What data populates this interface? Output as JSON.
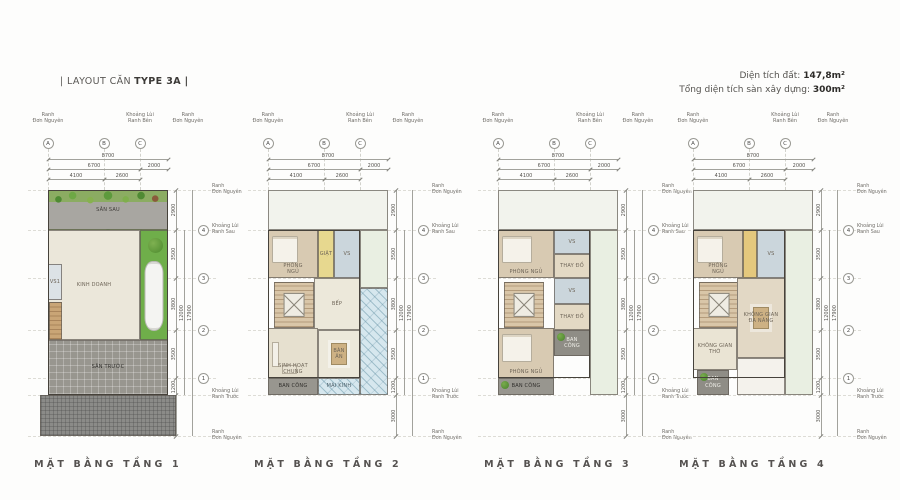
{
  "header": {
    "layout_prefix": "| LAYOUT CĂN",
    "layout_type": "TYPE 3A |",
    "land_area_label": "Diện tích đất:",
    "land_area_value": "147,8m²",
    "floor_area_label": "Tổng diện tích sàn xây dựng:",
    "floor_area_value": "300m²"
  },
  "annotations": {
    "top_labels": [
      {
        "text": "Ranh\nĐơn Nguyên",
        "cx": 30
      },
      {
        "text": "Khoảng Lùi\nRanh Bên",
        "cx": 122
      },
      {
        "text": "Ranh\nĐơn Nguyên",
        "cx": 170
      }
    ],
    "col_markers": [
      {
        "label": "A",
        "x": 0
      },
      {
        "label": "B",
        "x": 56
      },
      {
        "label": "C",
        "x": 92
      }
    ],
    "h_dim_rows": [
      {
        "y": 47,
        "spans": [
          {
            "label": "8700",
            "from": 0,
            "to": 120
          }
        ]
      },
      {
        "y": 57,
        "spans": [
          {
            "label": "6700",
            "from": 0,
            "to": 92
          },
          {
            "label": "2000",
            "from": 92,
            "to": 120
          }
        ]
      },
      {
        "y": 67,
        "spans": [
          {
            "label": "4100",
            "from": 0,
            "to": 56
          },
          {
            "label": "2600",
            "from": 56,
            "to": 92
          }
        ]
      }
    ],
    "v_bounds": [
      0,
      40,
      88,
      140,
      188,
      205,
      246
    ],
    "v_seg_labels": [
      "2900",
      "3500",
      "3800",
      "3500",
      "1200",
      "3000"
    ],
    "v_totals": [
      {
        "label": "12000",
        "from": 40,
        "to": 205
      },
      {
        "label": "17900",
        "from": 0,
        "to": 246
      }
    ],
    "row_markers": [
      {
        "label": "4",
        "y": 40
      },
      {
        "label": "3",
        "y": 88
      },
      {
        "label": "2",
        "y": 140
      },
      {
        "label": "1",
        "y": 188
      }
    ],
    "right_labels": [
      {
        "text": "Ranh\nĐơn Nguyên",
        "y": 0
      },
      {
        "text": "Khoảng Lùi\nRanh Sau",
        "y": 40
      },
      {
        "text": "Khoảng Lùi\nRanh Trước",
        "y": 205
      },
      {
        "text": "Ranh\nĐơn Nguyên",
        "y": 246
      }
    ]
  },
  "plans": [
    {
      "caption": "MẶT BẰNG TẦNG 1",
      "x": 18,
      "outline": {
        "x": 0,
        "y": 0,
        "w": 120,
        "h": 205
      },
      "rooms": [
        {
          "label": "SÂN SAU",
          "x": 0,
          "y": 0,
          "w": 120,
          "h": 40,
          "fill": "#a8a6a1",
          "pattern": "plants",
          "labelColor": "#3f3d39"
        },
        {
          "label": "KINH DOANH",
          "x": 0,
          "y": 40,
          "w": 92,
          "h": 110,
          "fill": "#ebe7da"
        },
        {
          "label": "",
          "x": 92,
          "y": 40,
          "w": 28,
          "h": 110,
          "fill": "#6fae4a",
          "pattern": "drive"
        },
        {
          "label": "VS1",
          "x": 0,
          "y": 74,
          "w": 14,
          "h": 36,
          "fill": "#dce2e6"
        },
        {
          "label": "",
          "x": 1,
          "y": 112,
          "w": 13,
          "h": 38,
          "fill": "#c9a576",
          "pattern": "stairs"
        },
        {
          "label": "SÂN TRƯỚC",
          "x": 0,
          "y": 150,
          "w": 120,
          "h": 55,
          "fill": "#98968f",
          "pattern": "grid",
          "labelColor": "#2f2e2b"
        },
        {
          "label": "",
          "x": -8,
          "y": 205,
          "w": 136,
          "h": 41,
          "fill": "#8b8b88",
          "pattern": "cobble"
        }
      ]
    },
    {
      "caption": "MẶT BẰNG TẦNG 2",
      "x": 238,
      "outline": {
        "x": 0,
        "y": 40,
        "w": 92,
        "h": 148
      },
      "rooms": [
        {
          "label": "",
          "x": 0,
          "y": 0,
          "w": 120,
          "h": 40,
          "fill": "#f2f3ed"
        },
        {
          "label": "",
          "x": 92,
          "y": 40,
          "w": 28,
          "h": 58,
          "fill": "#e9efe2"
        },
        {
          "label": "PHÒNG\nNGỦ",
          "x": 0,
          "y": 40,
          "w": 50,
          "h": 48,
          "fill": "#d8cab2",
          "pattern": "bed"
        },
        {
          "label": "GIẶT",
          "x": 50,
          "y": 40,
          "w": 16,
          "h": 48,
          "fill": "#e7d88f"
        },
        {
          "label": "VS",
          "x": 66,
          "y": 40,
          "w": 26,
          "h": 48,
          "fill": "#cbd6dc"
        },
        {
          "label": "",
          "x": 6,
          "y": 92,
          "w": 40,
          "h": 46,
          "fill": "#d9c6a8",
          "pattern": "stairs"
        },
        {
          "label": "BẾP",
          "x": 46,
          "y": 88,
          "w": 46,
          "h": 52,
          "fill": "#ece8da"
        },
        {
          "label": "SINH HOẠT\nCHUNG",
          "x": 0,
          "y": 138,
          "w": 50,
          "h": 50,
          "fill": "#e6e0cf",
          "pattern": "sofa"
        },
        {
          "label": "BÀN\nĂN",
          "x": 50,
          "y": 140,
          "w": 42,
          "h": 48,
          "fill": "#ece8da",
          "pattern": "table"
        },
        {
          "label": "BAN CÔNG",
          "x": 0,
          "y": 188,
          "w": 50,
          "h": 17,
          "fill": "#98968f",
          "labelColor": "#2f2e2b"
        },
        {
          "label": "",
          "x": 92,
          "y": 98,
          "w": 28,
          "h": 107,
          "fill": "#d6e7ee",
          "pattern": "glass"
        },
        {
          "label": "MÁI KÍNH",
          "x": 50,
          "y": 188,
          "w": 42,
          "h": 17,
          "fill": "#d6e7ee",
          "pattern": "glass",
          "labelColor": "#4a5e68"
        }
      ]
    },
    {
      "caption": "MẶT BẰNG TẦNG 3",
      "x": 468,
      "outline": {
        "x": 0,
        "y": 40,
        "w": 92,
        "h": 148
      },
      "rooms": [
        {
          "label": "",
          "x": 0,
          "y": 0,
          "w": 120,
          "h": 40,
          "fill": "#f2f3ed"
        },
        {
          "label": "",
          "x": 92,
          "y": 40,
          "w": 28,
          "h": 165,
          "fill": "#e9efe2"
        },
        {
          "label": "PHÒNG NGỦ",
          "x": 0,
          "y": 40,
          "w": 56,
          "h": 48,
          "fill": "#d8cab2",
          "pattern": "bed"
        },
        {
          "label": "VS",
          "x": 56,
          "y": 40,
          "w": 36,
          "h": 24,
          "fill": "#cbd6dc"
        },
        {
          "label": "THAY ĐỒ",
          "x": 56,
          "y": 64,
          "w": 36,
          "h": 24,
          "fill": "#e3d9c4"
        },
        {
          "label": "",
          "x": 6,
          "y": 92,
          "w": 40,
          "h": 46,
          "fill": "#d9c6a8",
          "pattern": "stairs"
        },
        {
          "label": "VS",
          "x": 56,
          "y": 88,
          "w": 36,
          "h": 26,
          "fill": "#cbd6dc"
        },
        {
          "label": "THAY ĐỒ",
          "x": 56,
          "y": 114,
          "w": 36,
          "h": 26,
          "fill": "#e3d9c4"
        },
        {
          "label": "PHÒNG NGỦ",
          "x": 0,
          "y": 138,
          "w": 56,
          "h": 50,
          "fill": "#d8cab2",
          "pattern": "bed"
        },
        {
          "label": "BAN\nCÔNG",
          "x": 56,
          "y": 140,
          "w": 36,
          "h": 26,
          "fill": "#8f8d86",
          "pattern": "shrub",
          "labelColor": "#f0efe9"
        },
        {
          "label": "BAN CÔNG",
          "x": 0,
          "y": 188,
          "w": 56,
          "h": 17,
          "fill": "#98968f",
          "pattern": "shrub",
          "labelColor": "#2f2e2b"
        }
      ]
    },
    {
      "caption": "MẶT BẰNG TẦNG 4",
      "x": 663,
      "outline": {
        "x": 0,
        "y": 40,
        "w": 92,
        "h": 148
      },
      "rooms": [
        {
          "label": "",
          "x": 0,
          "y": 0,
          "w": 120,
          "h": 40,
          "fill": "#f2f3ed"
        },
        {
          "label": "",
          "x": 92,
          "y": 40,
          "w": 28,
          "h": 165,
          "fill": "#e9efe2"
        },
        {
          "label": "PHÒNG\nNGỦ",
          "x": 0,
          "y": 40,
          "w": 50,
          "h": 48,
          "fill": "#d8cab2",
          "pattern": "bed"
        },
        {
          "label": "",
          "x": 50,
          "y": 40,
          "w": 14,
          "h": 48,
          "fill": "#e4c87d"
        },
        {
          "label": "VS",
          "x": 64,
          "y": 40,
          "w": 28,
          "h": 48,
          "fill": "#cbd6dc"
        },
        {
          "label": "",
          "x": 6,
          "y": 92,
          "w": 40,
          "h": 46,
          "fill": "#d9c6a8",
          "pattern": "stairs"
        },
        {
          "label": "KHÔNG GIAN\nĐA NĂNG",
          "x": 44,
          "y": 88,
          "w": 48,
          "h": 80,
          "fill": "#e2d8c5",
          "pattern": "table"
        },
        {
          "label": "KHÔNG GIAN THỜ",
          "x": 0,
          "y": 138,
          "w": 44,
          "h": 42,
          "fill": "#eae4d4"
        },
        {
          "label": "BAN\nCÔNG",
          "x": 4,
          "y": 180,
          "w": 32,
          "h": 25,
          "fill": "#8f8d86",
          "pattern": "shrub",
          "labelColor": "#f0efe9"
        },
        {
          "label": "",
          "x": 44,
          "y": 168,
          "w": 48,
          "h": 37,
          "fill": "#f4f2ec"
        }
      ]
    }
  ]
}
